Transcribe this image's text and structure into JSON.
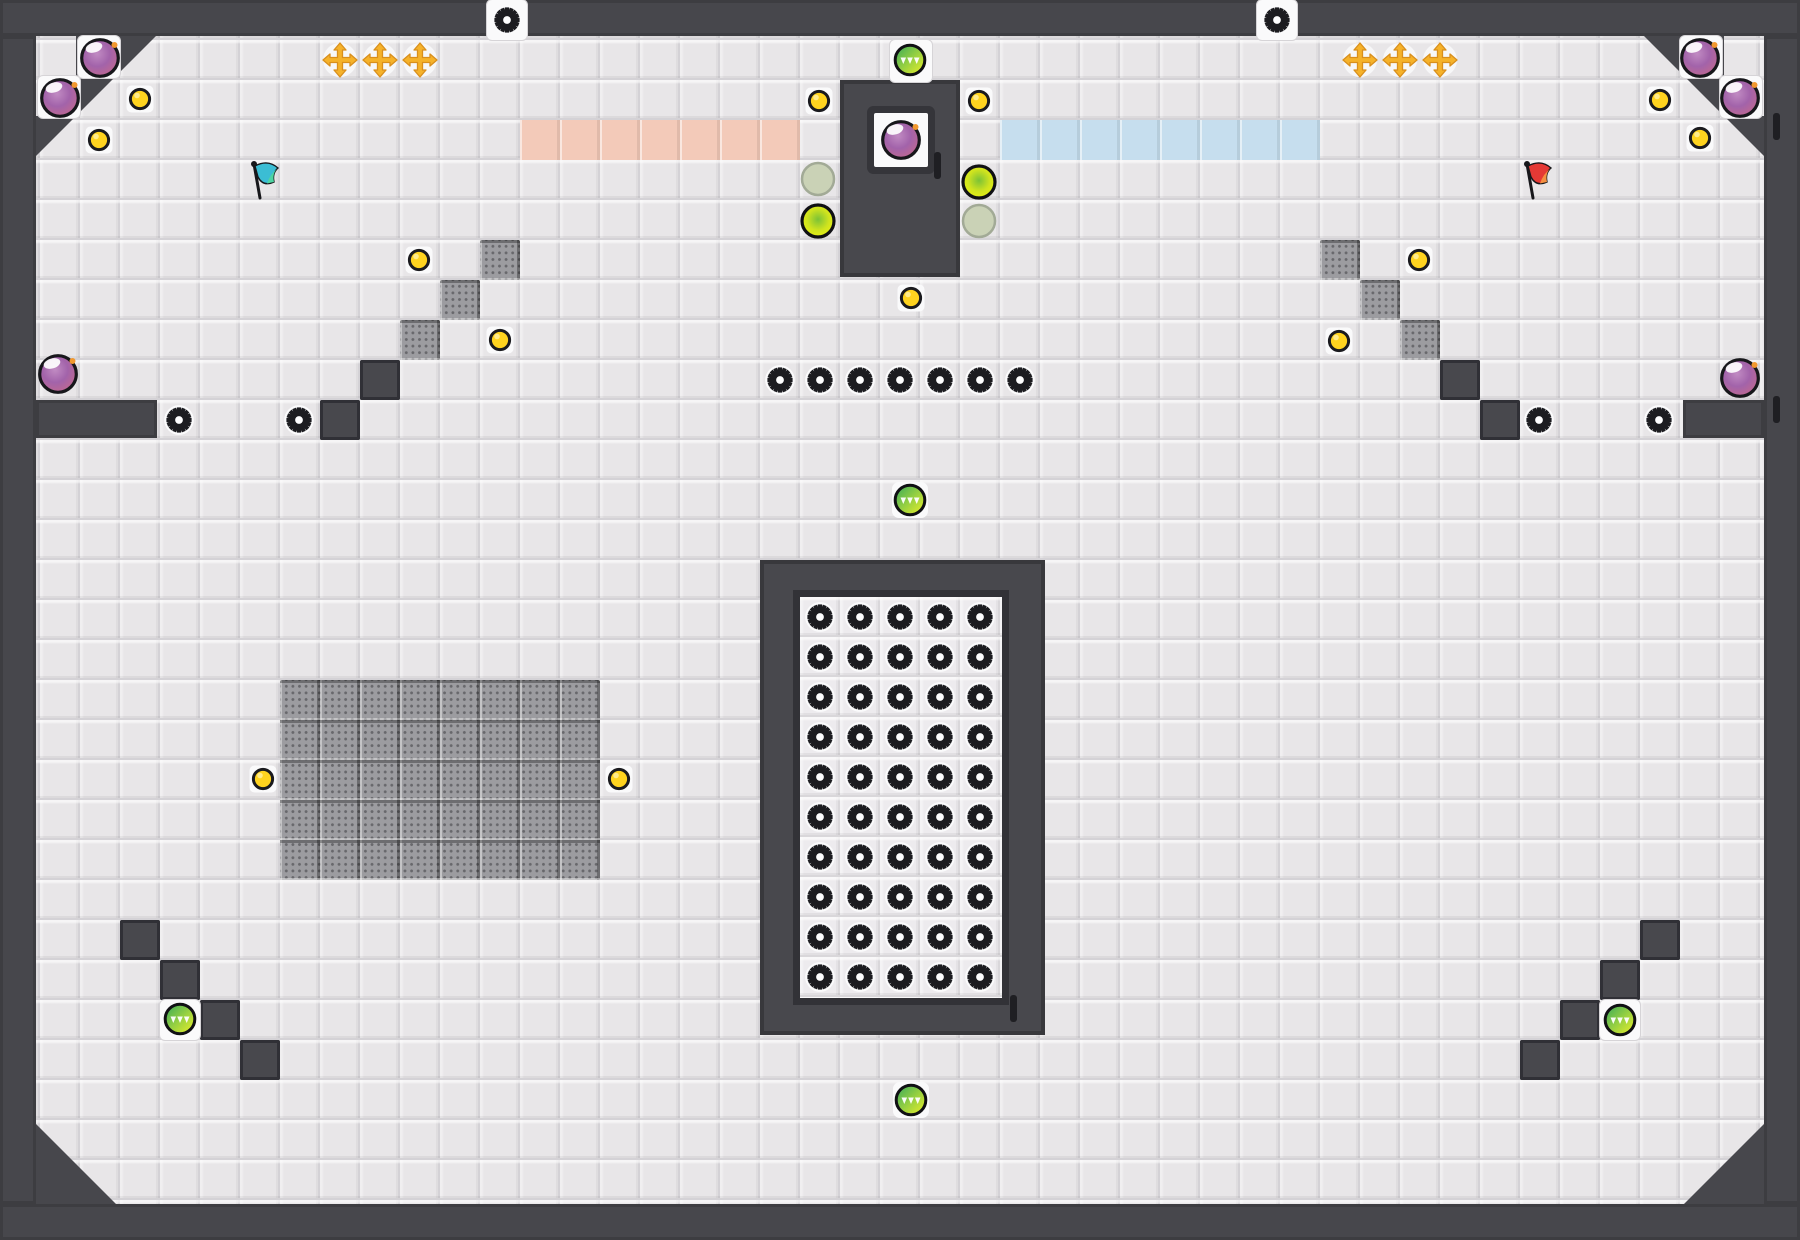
{
  "level": {
    "canvas": {
      "width": 1800,
      "height": 1240,
      "tile": 40
    },
    "colors": {
      "background": "#e8e6e8",
      "grid_line": "#d4d2d6",
      "wall": "#47474c",
      "dark_tile": "#48484d",
      "textured_tile": "#9c9ca0",
      "white_tile": "#fafafb",
      "pink_platform": "#f3cab9",
      "blue_platform": "#c6deee",
      "coin_gold": "#ffd31f",
      "saw_black": "#1c1c20",
      "bomb_purple": "#a263aa",
      "orb_green": "#9ed33f",
      "orb_active_yellow": "#eaf312",
      "orb_inactive": "#cad2b6",
      "cross_gold": "#f5b22a",
      "flag_left": "#3bbdd4",
      "flag_right": "#e53935",
      "door_marker": "#1f1f23"
    },
    "walls": {
      "frame": [
        {
          "name": "wall-top",
          "x": 0,
          "y": 0,
          "w": 1800,
          "h": 36
        },
        {
          "name": "wall-bottom",
          "x": 0,
          "y": 1204,
          "w": 1800,
          "h": 36
        },
        {
          "name": "wall-left",
          "x": 0,
          "y": 36,
          "w": 36,
          "h": 1168
        },
        {
          "name": "wall-right",
          "x": 1764,
          "y": 36,
          "w": 36,
          "h": 1168
        },
        {
          "name": "ledge-left",
          "x": 36,
          "y": 400,
          "w": 121,
          "h": 38
        },
        {
          "name": "ledge-right",
          "x": 1683,
          "y": 400,
          "w": 81,
          "h": 38
        }
      ],
      "corner_polys": [
        {
          "name": "corner-top-left",
          "points": "76,36 156,36 36,156 36,116 76,116"
        },
        {
          "name": "corner-top-right",
          "points": "1724,36 1644,36 1764,156 1764,116 1724,116"
        },
        {
          "name": "corner-bottom-left",
          "points": "36,1124 116,1204 36,1204"
        },
        {
          "name": "corner-bottom-right",
          "points": "1764,1124 1684,1204 1764,1204"
        }
      ]
    },
    "structures": {
      "bomb_cabin": {
        "x": 840,
        "y": 80,
        "w": 120,
        "h": 197,
        "window": {
          "x": 874,
          "y": 113,
          "w": 54,
          "h": 54
        }
      },
      "saw_chamber": {
        "x": 760,
        "y": 560,
        "w": 285,
        "h": 475,
        "inner": {
          "x": 800,
          "y": 597,
          "w": 202,
          "h": 401
        }
      },
      "pink_platform": {
        "x": 520,
        "y": 120,
        "w": 280,
        "h": 40
      },
      "blue_platform": {
        "x": 1000,
        "y": 120,
        "w": 320,
        "h": 40
      },
      "textured_area": {
        "x": 280,
        "y": 680,
        "w": 320,
        "h": 200
      }
    },
    "white_tiles": [
      {
        "x": 78,
        "y": 36,
        "w": 42,
        "h": 42
      },
      {
        "x": 38,
        "y": 76,
        "w": 42,
        "h": 42
      },
      {
        "x": 1680,
        "y": 36,
        "w": 42,
        "h": 42
      },
      {
        "x": 1720,
        "y": 76,
        "w": 42,
        "h": 42
      },
      {
        "x": 487,
        "y": 0,
        "w": 40,
        "h": 40
      },
      {
        "x": 1257,
        "y": 0,
        "w": 40,
        "h": 40
      },
      {
        "x": 890,
        "y": 40,
        "w": 42,
        "h": 42
      },
      {
        "x": 160,
        "y": 1000,
        "w": 40,
        "h": 40
      },
      {
        "x": 1600,
        "y": 1000,
        "w": 40,
        "h": 40
      }
    ],
    "textured_tiles": [
      {
        "x": 480,
        "y": 240
      },
      {
        "x": 440,
        "y": 280
      },
      {
        "x": 400,
        "y": 320
      },
      {
        "x": 1320,
        "y": 240
      },
      {
        "x": 1360,
        "y": 280
      },
      {
        "x": 1400,
        "y": 320
      }
    ],
    "dark_tiles": [
      {
        "x": 360,
        "y": 360
      },
      {
        "x": 320,
        "y": 400
      },
      {
        "x": 1440,
        "y": 360
      },
      {
        "x": 1480,
        "y": 400
      },
      {
        "x": 120,
        "y": 920
      },
      {
        "x": 160,
        "y": 960
      },
      {
        "x": 200,
        "y": 1000
      },
      {
        "x": 240,
        "y": 1040
      },
      {
        "x": 1640,
        "y": 920
      },
      {
        "x": 1600,
        "y": 960
      },
      {
        "x": 1560,
        "y": 1000
      },
      {
        "x": 1520,
        "y": 1040
      }
    ],
    "saws": {
      "singles": [
        [
          507,
          20
        ],
        [
          1277,
          20
        ],
        [
          179,
          420
        ],
        [
          299,
          420
        ],
        [
          1539,
          420
        ],
        [
          1659,
          420
        ],
        [
          780,
          380
        ],
        [
          820,
          380
        ],
        [
          860,
          380
        ],
        [
          900,
          380
        ],
        [
          940,
          380
        ],
        [
          980,
          380
        ],
        [
          1020,
          380
        ]
      ],
      "chamber_grid": {
        "x0": 820,
        "y0": 617,
        "dx": 40,
        "dy": 40,
        "cols": 5,
        "rows": 10
      }
    },
    "coins": [
      [
        140,
        99
      ],
      [
        99,
        140
      ],
      [
        1660,
        100
      ],
      [
        1700,
        138
      ],
      [
        819,
        101
      ],
      [
        979,
        101
      ],
      [
        911,
        298
      ],
      [
        419,
        260
      ],
      [
        500,
        340
      ],
      [
        1419,
        260
      ],
      [
        1339,
        341
      ],
      [
        263,
        779
      ],
      [
        619,
        779
      ]
    ],
    "bombs": [
      [
        100,
        58
      ],
      [
        60,
        98
      ],
      [
        1700,
        58
      ],
      [
        1740,
        98
      ],
      [
        901,
        140
      ],
      [
        58,
        374
      ],
      [
        1740,
        378
      ]
    ],
    "green_orbs": [
      [
        910,
        60
      ],
      [
        910,
        500
      ],
      [
        911,
        1100
      ],
      [
        180,
        1019
      ],
      [
        1620,
        1020
      ]
    ],
    "active_orbs": [
      [
        818,
        221
      ],
      [
        979,
        182
      ]
    ],
    "inactive_orbs": [
      [
        818,
        179
      ],
      [
        979,
        221
      ]
    ],
    "gold_crosses": [
      [
        340,
        60
      ],
      [
        380,
        60
      ],
      [
        420,
        60
      ],
      [
        1360,
        60
      ],
      [
        1400,
        60
      ],
      [
        1440,
        60
      ]
    ],
    "flags": [
      {
        "name": "flag-teal",
        "x": 262,
        "y": 180,
        "color": "#3bbdd4",
        "tip": "#4fd6a0"
      },
      {
        "name": "flag-red",
        "x": 1535,
        "y": 180,
        "color": "#e53935",
        "tip": "#f59342"
      }
    ],
    "door_markers": [
      {
        "x": 934,
        "y": 152
      },
      {
        "x": 1010,
        "y": 995
      },
      {
        "x": 1773,
        "y": 113
      },
      {
        "x": 1773,
        "y": 396
      }
    ]
  }
}
